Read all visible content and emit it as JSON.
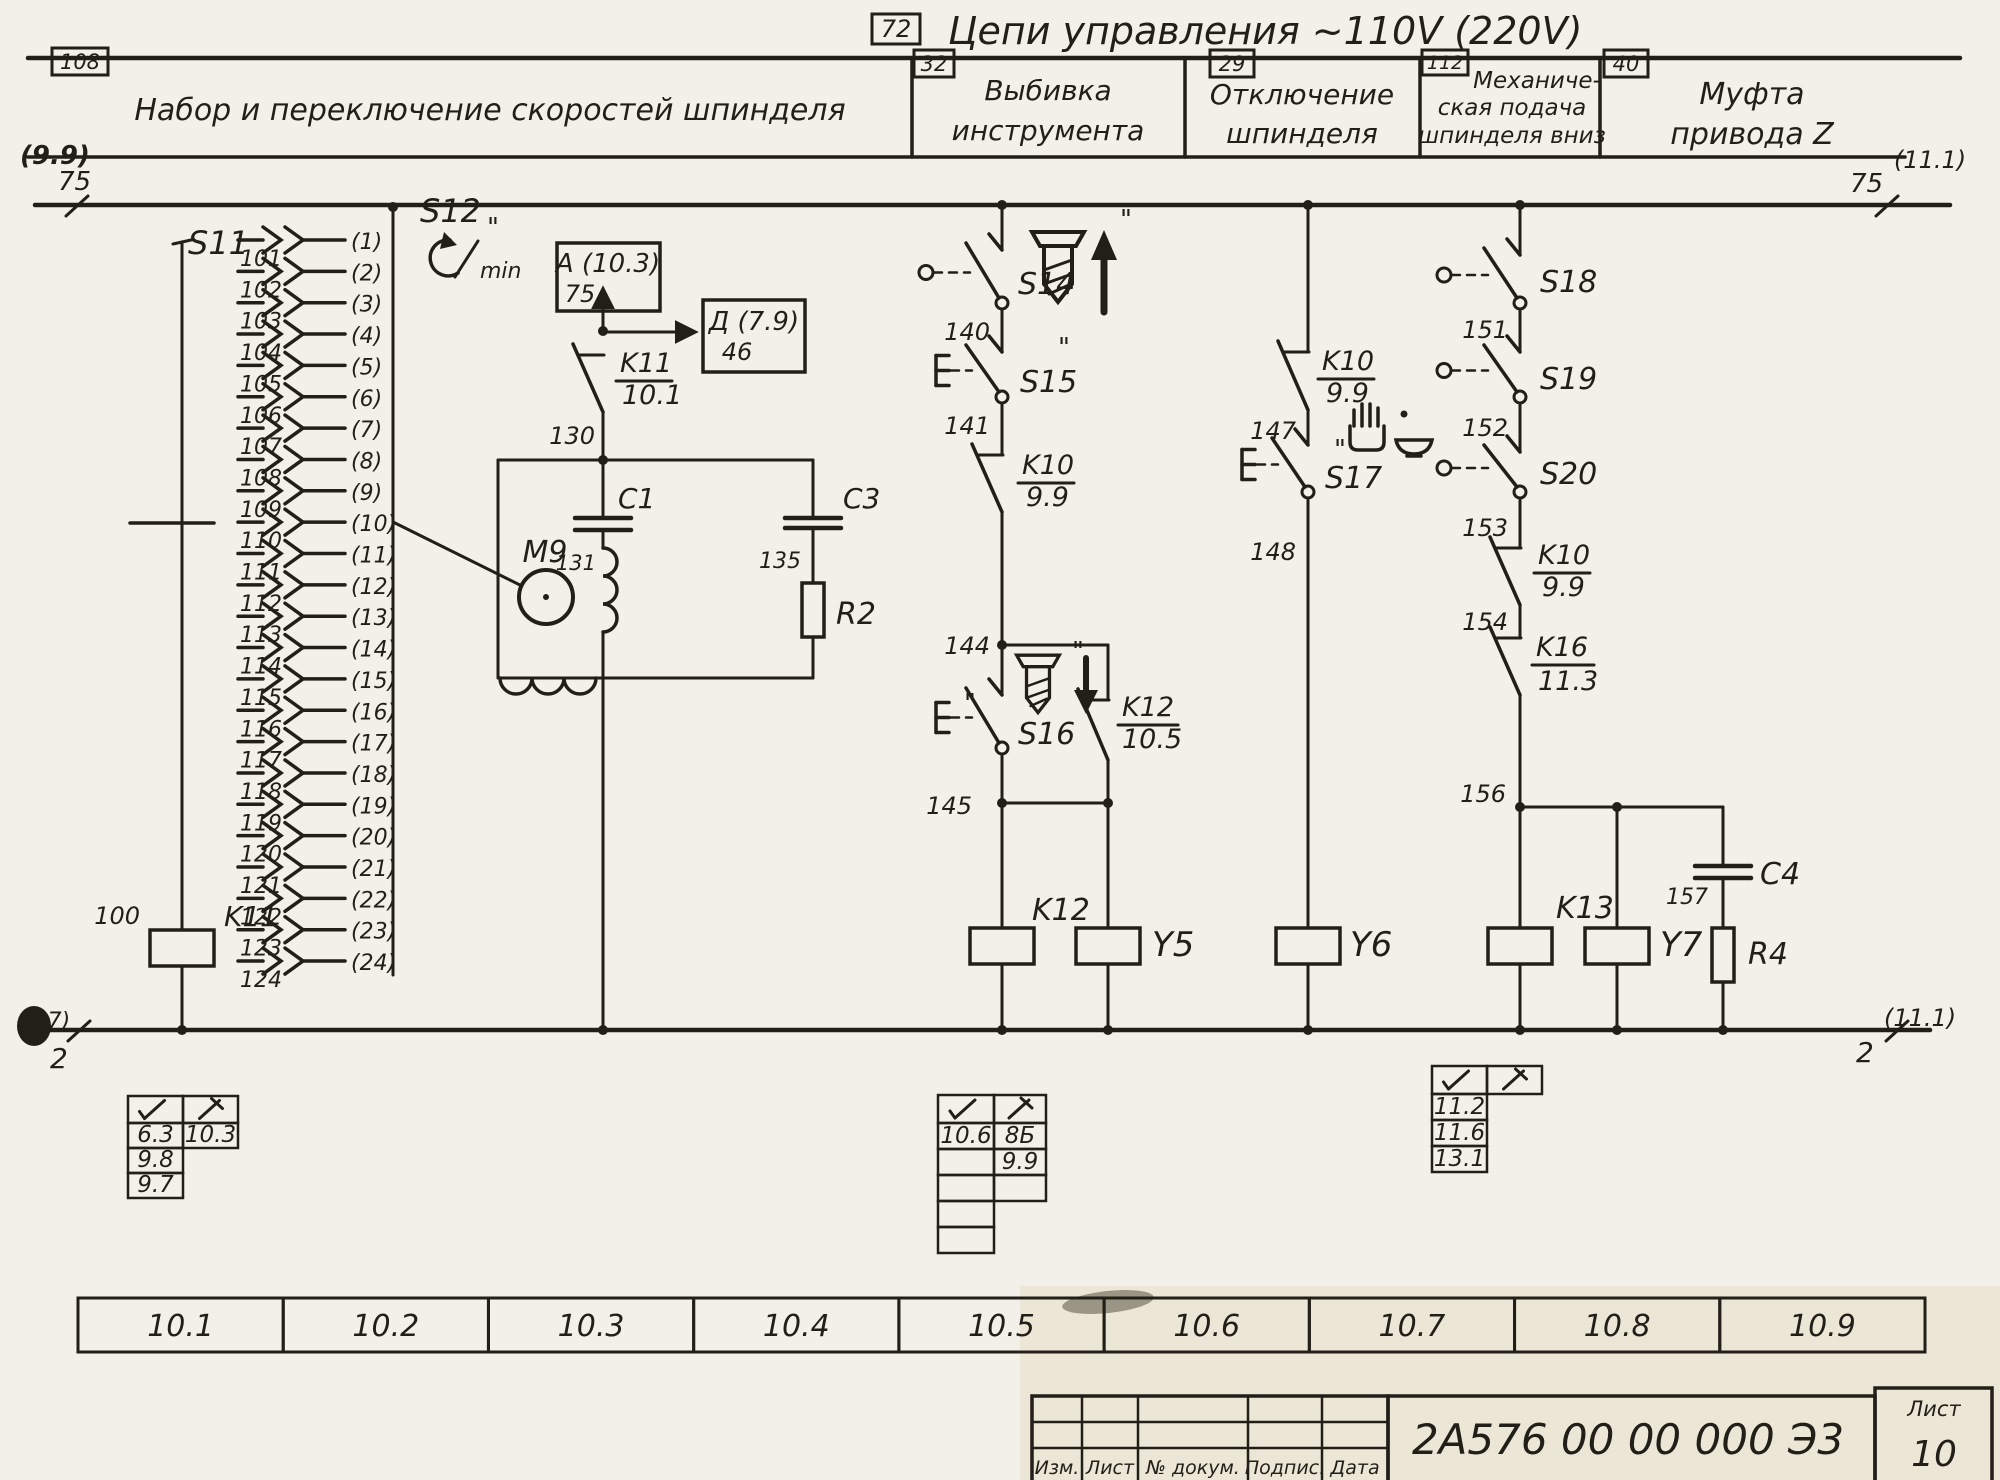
{
  "page": {
    "paper_color": "#f3f0e9",
    "ink_color": "#221e18",
    "shade_color": "#d8cdb0"
  },
  "marks": {
    "ditto": "\""
  },
  "title": {
    "tag": "72",
    "text": "Цепи управления ~110V (220V)"
  },
  "sections": [
    {
      "tag": "108",
      "lines": [
        "Набор и переключение скоростей  шпинделя"
      ]
    },
    {
      "tag": "32",
      "lines": [
        "Выбивка",
        "инструмента"
      ]
    },
    {
      "tag": "29",
      "lines": [
        "Отключение",
        "шпинделя"
      ]
    },
    {
      "tag": "112",
      "lines": [
        "Механиче-",
        "ская подача",
        "шпинделя вниз"
      ]
    },
    {
      "tag": "40",
      "lines": [
        "Муфта",
        "привода Z"
      ]
    }
  ],
  "bus": {
    "top_left_ref": "(9.9)",
    "top_left_wire": "75",
    "top_right_ref": "(11.1)",
    "top_right_wire": "75",
    "bottom_left_ref": "(9.7)",
    "bottom_left_wire": "2",
    "bottom_right_ref": "(11.1)",
    "bottom_right_wire": "2"
  },
  "s11": {
    "name": "S11",
    "rows": [
      {
        "w": "101",
        "c": "(1)"
      },
      {
        "w": "102",
        "c": "(2)"
      },
      {
        "w": "103",
        "c": "(3)"
      },
      {
        "w": "104",
        "c": "(4)"
      },
      {
        "w": "105",
        "c": "(5)"
      },
      {
        "w": "106",
        "c": "(6)"
      },
      {
        "w": "107",
        "c": "(7)"
      },
      {
        "w": "108",
        "c": "(8)"
      },
      {
        "w": "109",
        "c": "(9)"
      },
      {
        "w": "110",
        "c": "(10)"
      },
      {
        "w": "111",
        "c": "(11)"
      },
      {
        "w": "112",
        "c": "(12)"
      },
      {
        "w": "113",
        "c": "(13)"
      },
      {
        "w": "114",
        "c": "(14)"
      },
      {
        "w": "115",
        "c": "(15)"
      },
      {
        "w": "116",
        "c": "(16)"
      },
      {
        "w": "117",
        "c": "(17)"
      },
      {
        "w": "118",
        "c": "(18)"
      },
      {
        "w": "119",
        "c": "(19)"
      },
      {
        "w": "120",
        "c": "(20)"
      },
      {
        "w": "121",
        "c": "(21)"
      },
      {
        "w": "122",
        "c": "(22)"
      },
      {
        "w": "123",
        "c": "(23)"
      },
      {
        "w": "124",
        "c": "(24)"
      }
    ]
  },
  "col1": {
    "w100": "100",
    "k11_coil": "K11",
    "s12": "S12",
    "s12_unit": "min",
    "box_a": "А (10.3)",
    "box_a_wire": "75",
    "box_d": "Д (7.9)",
    "box_d_wire": "46",
    "k11_name": "K11",
    "k11_ref": "10.1",
    "w130": "130",
    "m9": "M9",
    "c1": "C1",
    "w131": "131",
    "c3": "C3",
    "w135": "135",
    "r2": "R2"
  },
  "col2": {
    "s14": "S14",
    "w140": "140",
    "s15": "S15",
    "w141": "141",
    "k10_name": "K10",
    "k10_ref": "9.9",
    "w144": "144",
    "s16": "S16",
    "k12_name": "K12",
    "k12_ref": "10.5",
    "w145": "145",
    "k12_coil": "K12",
    "y5": "Y5"
  },
  "col3": {
    "k10_name": "K10",
    "k10_ref": "9.9",
    "w147": "147",
    "s17": "S17",
    "w148": "148",
    "y6": "Y6"
  },
  "col4": {
    "s18": "S18",
    "w151": "151",
    "s19": "S19",
    "w152": "152",
    "s20": "S20",
    "w153": "153",
    "k10_name": "K10",
    "k10_ref": "9.9",
    "w154": "154",
    "k16_name": "K16",
    "k16_ref": "11.3",
    "w156": "156",
    "k13": "K13",
    "y7": "Y7",
    "c4": "C4",
    "w157": "157",
    "r4": "R4"
  },
  "xref_left": {
    "col1": [
      "6.3",
      "9.8",
      "9.7"
    ],
    "col2": [
      "10.3"
    ]
  },
  "xref_mid": {
    "col1": [
      "10.6",
      "",
      "",
      "",
      ""
    ],
    "col2": [
      "8Б",
      "9.9",
      ""
    ]
  },
  "xref_right": {
    "col1": [
      "11.2",
      "11.6",
      "13.1"
    ],
    "col2": []
  },
  "sheet_strip": [
    "10.1",
    "10.2",
    "10.3",
    "10.4",
    "10.5",
    "10.6",
    "10.7",
    "10.8",
    "10.9"
  ],
  "title_block": {
    "cols": [
      "Изм.",
      "Лист",
      "№ докум.",
      "Подпис.",
      "Дата"
    ],
    "doc_number": "2А576 00 00 000 Э3",
    "sheet_label": "Лист",
    "sheet_no": "10"
  }
}
